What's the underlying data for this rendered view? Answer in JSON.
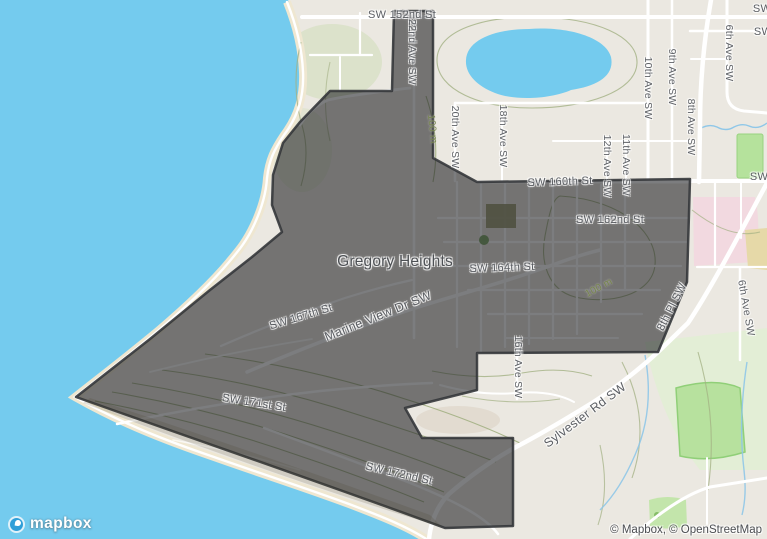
{
  "neighborhood": "Gregory Heights",
  "labels": {
    "sw152": {
      "text": "SW 152nd St"
    },
    "sw160": {
      "text": "SW 160th St"
    },
    "sw162": {
      "text": "SW 162nd St"
    },
    "sw164": {
      "text": "SW 164th St"
    },
    "sw167": {
      "text": "SW 167th St"
    },
    "sw171": {
      "text": "SW 171st St"
    },
    "sw172": {
      "text": "SW 172nd St"
    },
    "marine": {
      "text": "Marine View Dr SW"
    },
    "sylvester": {
      "text": "Sylvester Rd SW"
    },
    "pl8": {
      "text": "8th Pl SW"
    },
    "ave22": {
      "text": "22nd Ave SW"
    },
    "ave20": {
      "text": "20th Ave SW"
    },
    "ave18": {
      "text": "18th Ave SW"
    },
    "ave16": {
      "text": "16th Ave SW"
    },
    "ave12": {
      "text": "12th Ave SW"
    },
    "ave11": {
      "text": "11th Ave SW"
    },
    "ave10": {
      "text": "10th Ave SW"
    },
    "ave9": {
      "text": "9th Ave SW"
    },
    "ave8": {
      "text": "8th Ave SW"
    },
    "ave6_top": {
      "text": "6th Ave SW"
    },
    "ave6_south": {
      "text": "6th Ave SW"
    },
    "edge_sw_1": {
      "text": "SW"
    },
    "edge_sw_2": {
      "text": "SW"
    },
    "edge_sw_3": {
      "text": "SW"
    },
    "contour_100m_a": {
      "text": "100 m"
    },
    "contour_100m_b": {
      "text": "100 m"
    }
  },
  "attribution": {
    "text": "© Mapbox, © OpenStreetMap"
  },
  "logo": {
    "text": "mapbox"
  },
  "icons": {
    "logo_icon": "mapbox-circle-pin"
  },
  "colors": {
    "water": "#74cbee",
    "land": "#ebe8e1",
    "boundary_stroke": "#35373b",
    "boundary_fill": "rgba(30,31,34,0.58)",
    "park_green": "#b7e19e",
    "school_pink": "#f2d9e0",
    "beach_sand": "#efe7d1"
  }
}
